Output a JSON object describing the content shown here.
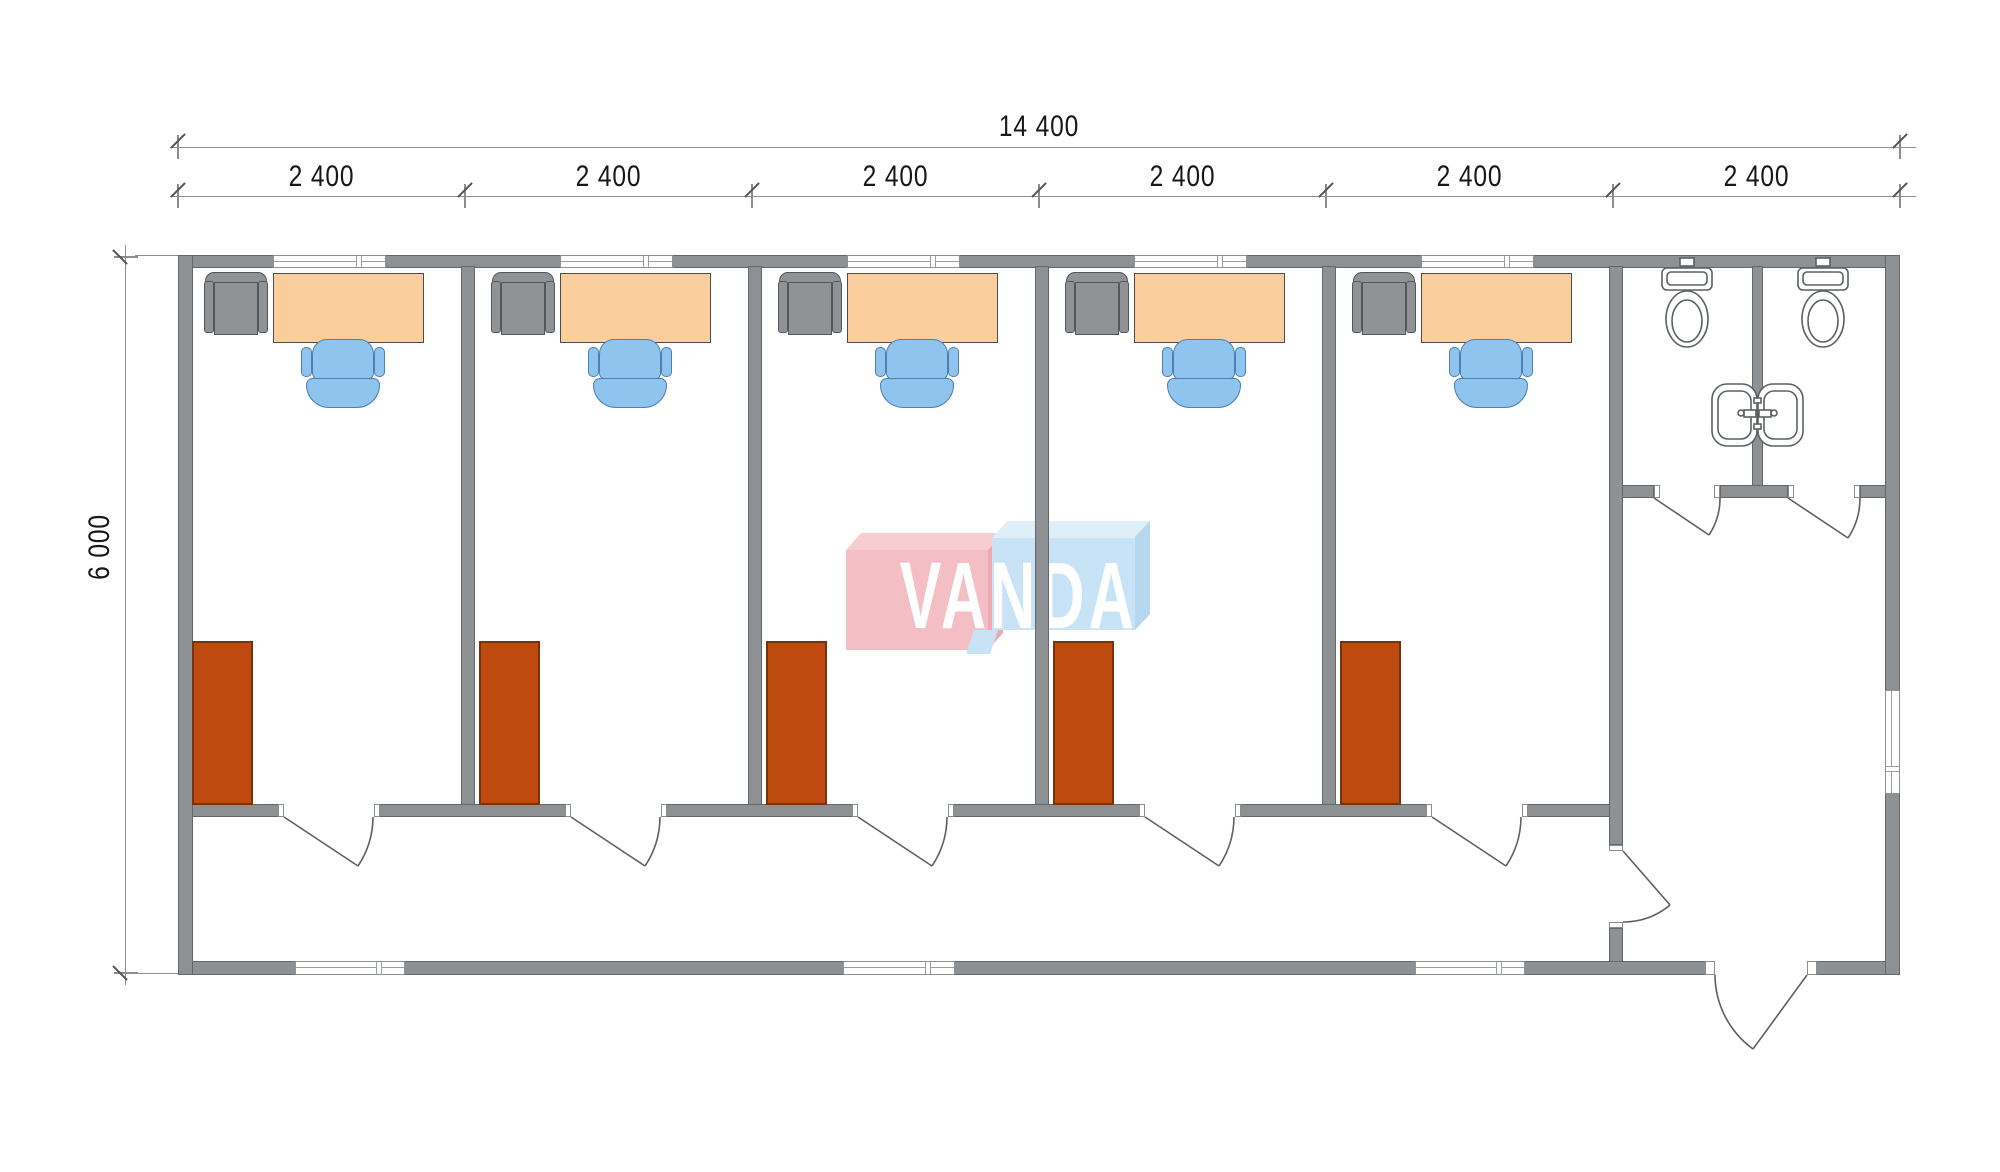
{
  "dimensions": {
    "total_width": "14 400",
    "bay_widths": [
      "2 400",
      "2 400",
      "2 400",
      "2 400",
      "2 400",
      "2 400"
    ],
    "height": "6 000"
  },
  "watermark": {
    "text": "VANDA"
  },
  "layout_counts": {
    "office_rooms": 5,
    "toilet_stalls": 2,
    "washbasins": 2,
    "entrance_doors": 1
  },
  "colors": {
    "wall": "#8D9193",
    "wall-edge": "#64686B",
    "desk": "#FACE9C",
    "desk-edge": "#4C4C4C",
    "armchair": "#909395",
    "armchair-edge": "#54575A",
    "chair": "#8FC4EF",
    "chair-edge": "#4C80B0",
    "cabinet": "#BE4A0F",
    "cabinet-edge": "#78320C",
    "fixture-line": "#5C6063",
    "dim-line": "#8A8E90",
    "dim-tick": "#515456",
    "dim-text": "#161718",
    "logo-pink": "#F3BFC5",
    "logo-pink-top": "#F7CDD1",
    "logo-pink-side": "#ECA9B4",
    "logo-blue": "#C9E3F6",
    "logo-blue-top": "#DFEFFA",
    "logo-blue-side": "#B7D7EE",
    "logo-text": "#FFFFFF"
  }
}
